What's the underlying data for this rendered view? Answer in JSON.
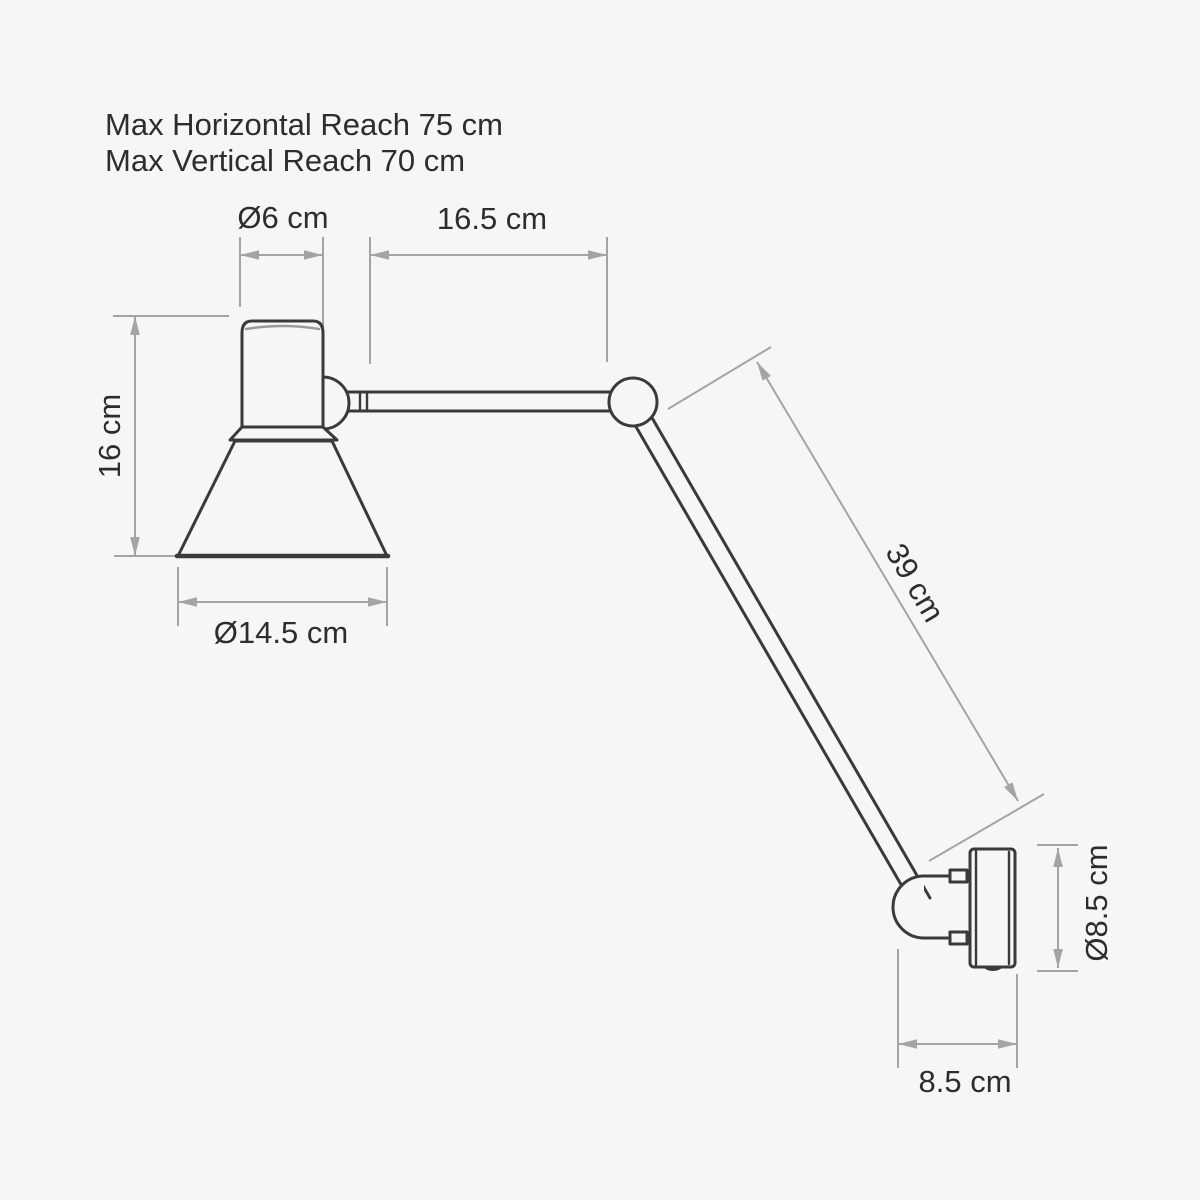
{
  "colors": {
    "background": "#f6f6f6",
    "outline": "#3a3a3a",
    "dimension_lines": "#a4a4a4",
    "text": "#2d2d2d"
  },
  "notes": {
    "horizontal_reach": "Max Horizontal Reach 75 cm",
    "vertical_reach": "Max Vertical Reach 70 cm"
  },
  "dims": {
    "cap_diameter": "Ø6 cm",
    "upper_arm_length": "16.5 cm",
    "head_height": "16 cm",
    "shade_diameter": "Ø14.5 cm",
    "lower_arm_length": "39 cm",
    "wall_plate_diameter": "Ø8.5 cm",
    "wall_plate_depth": "8.5 cm"
  }
}
